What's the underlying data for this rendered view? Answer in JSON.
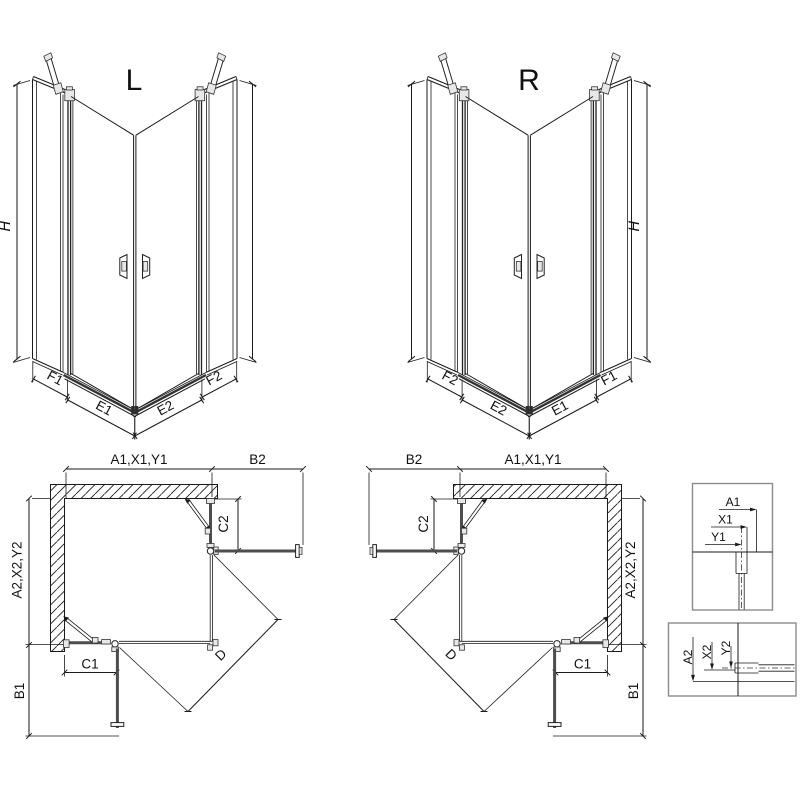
{
  "drawing": {
    "view_l": {
      "title": "L",
      "h_label": "H",
      "f1": "F1",
      "e1": "E1",
      "e2": "E2",
      "f2": "F2"
    },
    "view_r": {
      "title": "R",
      "h_label": "H",
      "f1": "F1",
      "e1": "E1",
      "e2": "E2",
      "f2": "F2"
    },
    "plan_l": {
      "top_width": "A1,X1,Y1",
      "top_side": "B2",
      "side_height": "A2,X2,Y2",
      "side_bottom": "B1",
      "fixed_bottom": "C1",
      "fixed_side": "C2",
      "diagonal": "D"
    },
    "plan_r": {
      "top_width": "A1,X1,Y1",
      "top_side": "B2",
      "side_height": "A2,X2,Y2",
      "side_bottom": "B1",
      "fixed_bottom": "C1",
      "fixed_side": "C2",
      "diagonal": "D"
    },
    "detail_top": {
      "a": "A1",
      "x": "X1",
      "y": "Y1"
    },
    "detail_bottom": {
      "a": "A2",
      "x": "X2",
      "y": "Y2"
    },
    "colors": {
      "line": "#1a1a1a",
      "glass": "#4d4d4d",
      "box_border": "#8c8c8c",
      "fitting_fill": "#e8e8e8"
    }
  }
}
